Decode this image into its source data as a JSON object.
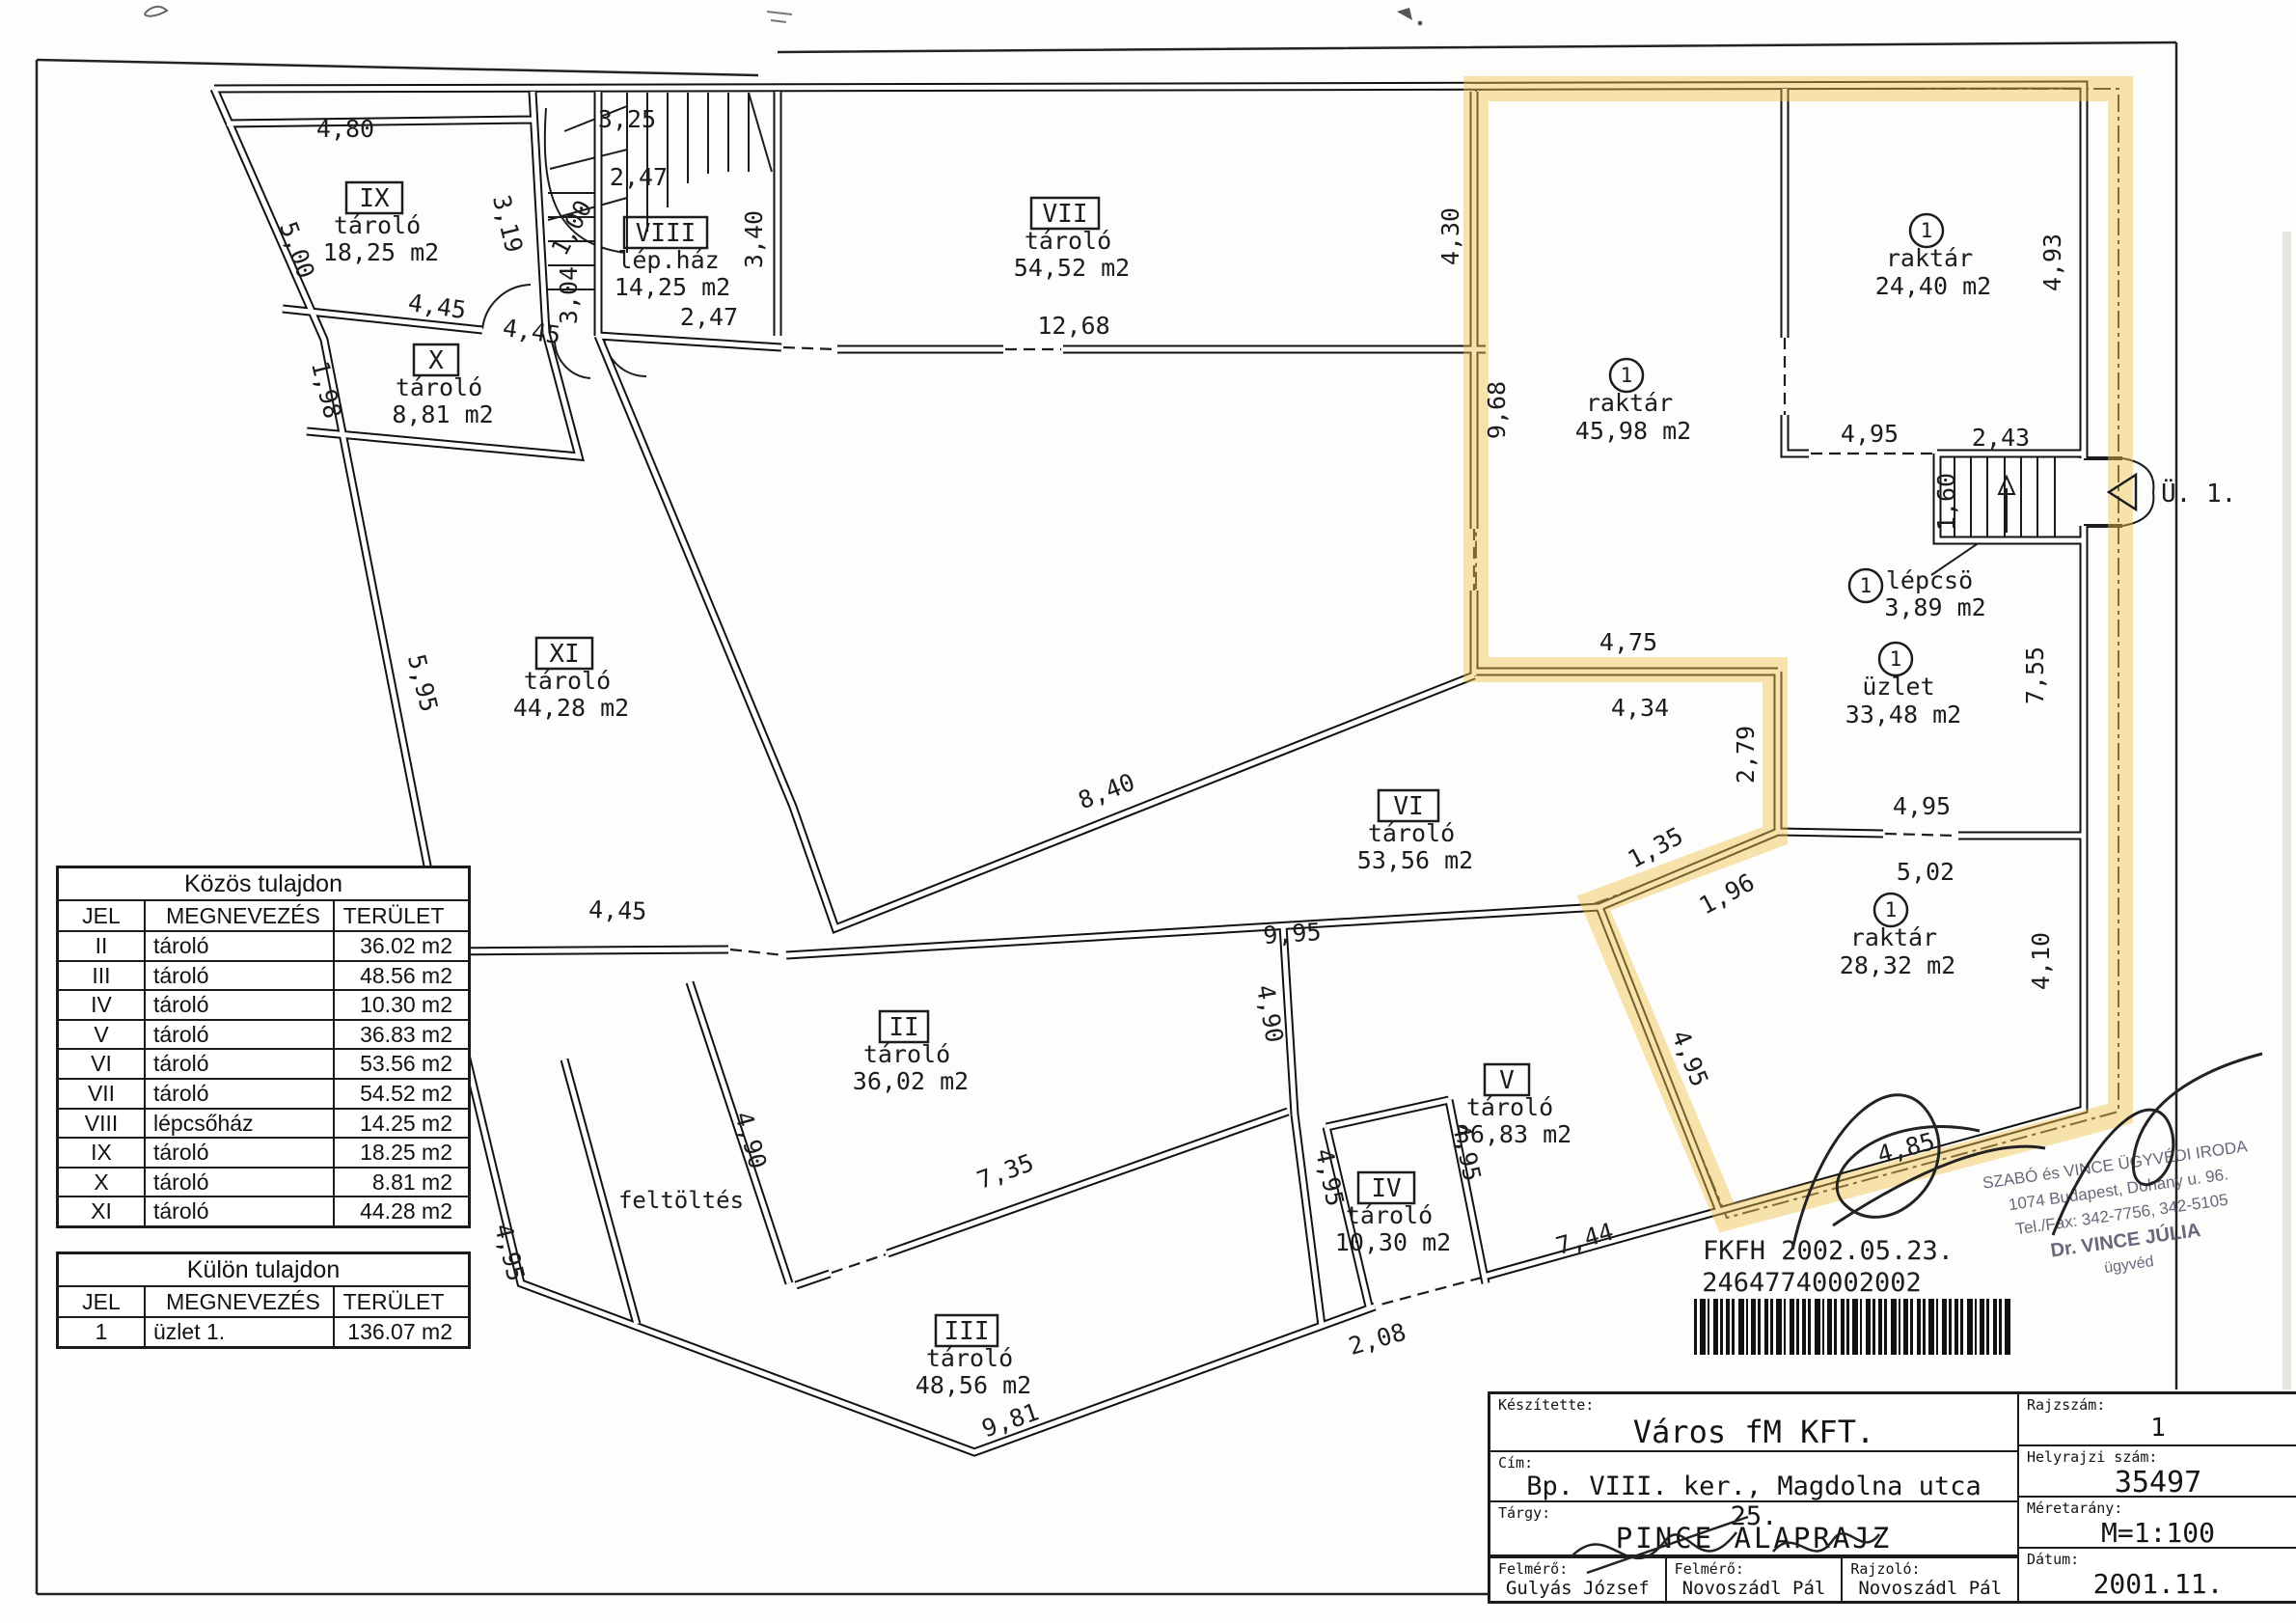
{
  "colors": {
    "highlight": "#f0c14b",
    "ink": "#1c1c1e",
    "stamp_ink": "#4d4d66"
  },
  "plan": {
    "unit_mark": "1",
    "entrance_label": "Ü. 1.",
    "fill_label": "feltöltés",
    "rooms": [
      {
        "id": "IX",
        "name": "tároló",
        "area": "18,25 m2"
      },
      {
        "id": "X",
        "name": "tároló",
        "area": "8,81 m2"
      },
      {
        "id": "VIII",
        "name": "lép.ház",
        "area": "14,25 m2"
      },
      {
        "id": "VII",
        "name": "tároló",
        "area": "54,52 m2"
      },
      {
        "id": "XI",
        "name": "tároló",
        "area": "44,28 m2"
      },
      {
        "id": "VI",
        "name": "tároló",
        "area": "53,56 m2"
      },
      {
        "id": "II",
        "name": "tároló",
        "area": "36,02 m2"
      },
      {
        "id": "V",
        "name": "tároló",
        "area": "36,83 m2"
      },
      {
        "id": "IV",
        "name": "tároló",
        "area": "10,30 m2"
      },
      {
        "id": "III",
        "name": "tároló",
        "area": "48,56 m2"
      }
    ],
    "unit_rooms": [
      {
        "name": "raktár",
        "area": "45,98 m2"
      },
      {
        "name": "raktár",
        "area": "24,40 m2"
      },
      {
        "name": "lépcsö",
        "area": "3,89 m2"
      },
      {
        "name": "üzlet",
        "area": "33,48 m2"
      },
      {
        "name": "raktár",
        "area": "28,32 m2"
      }
    ],
    "dims": [
      "4,80",
      "3,25",
      "2,47",
      "1,00",
      "3,04",
      "2,47",
      "3,40",
      "12,68",
      "4,30",
      "9,68",
      "4,93",
      "4,95",
      "2,43",
      "1,60",
      "7,55",
      "4,75",
      "4,34",
      "2,79",
      "1,35",
      "1,96",
      "4,95",
      "5,02",
      "4,10",
      "4,95",
      "4,85",
      "8,40",
      "9,95",
      "4,90",
      "7,35",
      "4,90",
      "4,45",
      "9,81",
      "2,08",
      "7,44",
      "4,95",
      "4,95",
      "5,95",
      "4,45",
      "4,45",
      "5,00",
      "3,19",
      "1,98",
      "4,95"
    ]
  },
  "tables": {
    "common": {
      "title": "Közös tulajdon",
      "headers": [
        "JEL",
        "MEGNEVEZÉS",
        "TERÜLET"
      ],
      "rows": [
        [
          "II",
          "tároló",
          "36.02 m2"
        ],
        [
          "III",
          "tároló",
          "48.56 m2"
        ],
        [
          "IV",
          "tároló",
          "10.30 m2"
        ],
        [
          "V",
          "tároló",
          "36.83 m2"
        ],
        [
          "VI",
          "tároló",
          "53.56 m2"
        ],
        [
          "VII",
          "tároló",
          "54.52 m2"
        ],
        [
          "VIII",
          "lépcsőház",
          "14.25 m2"
        ],
        [
          "IX",
          "tároló",
          "18.25 m2"
        ],
        [
          "X",
          "tároló",
          "8.81 m2"
        ],
        [
          "XI",
          "tároló",
          "44.28 m2"
        ]
      ]
    },
    "separate": {
      "title": "Külön tulajdon",
      "headers": [
        "JEL",
        "MEGNEVEZÉS",
        "TERÜLET"
      ],
      "rows": [
        [
          "1",
          "üzlet 1.",
          "136.07 m2"
        ]
      ]
    }
  },
  "title_block": {
    "made_by_label": "Készítette:",
    "made_by": "Város fM KFT.",
    "address_label": "Cím:",
    "address": "Bp. VIII. ker., Magdolna utca 25.",
    "subject_label": "Tárgy:",
    "subject": "PINCE ALAPRAJZ",
    "surveyor1_label": "Felmérő:",
    "surveyor1": "Gulyás József",
    "surveyor2_label": "Felmérő:",
    "surveyor2": "Novoszádl Pál",
    "drafter_label": "Rajzoló:",
    "drafter": "Novoszádl Pál",
    "drawing_no_label": "Rajzszám:",
    "drawing_no": "1",
    "parcel_label": "Helyrajzi szám:",
    "parcel": "35497",
    "scale_label": "Méretarány:",
    "scale": "M=1:100",
    "date_label": "Dátum:",
    "date": "2001.11."
  },
  "stamp": {
    "line1": "SZABÓ és VINCE ÜGYVÉDI IRODA",
    "line2": "1074 Budapest, Dohány u. 96.",
    "line3": "Tel./Fax: 342-7756, 342-5105",
    "line4": "Dr. VINCE JÚLIA",
    "line5": "ügyvéd"
  },
  "barcode": {
    "agency": "FKFH 2002.05.23.",
    "number": "24647740002002"
  }
}
